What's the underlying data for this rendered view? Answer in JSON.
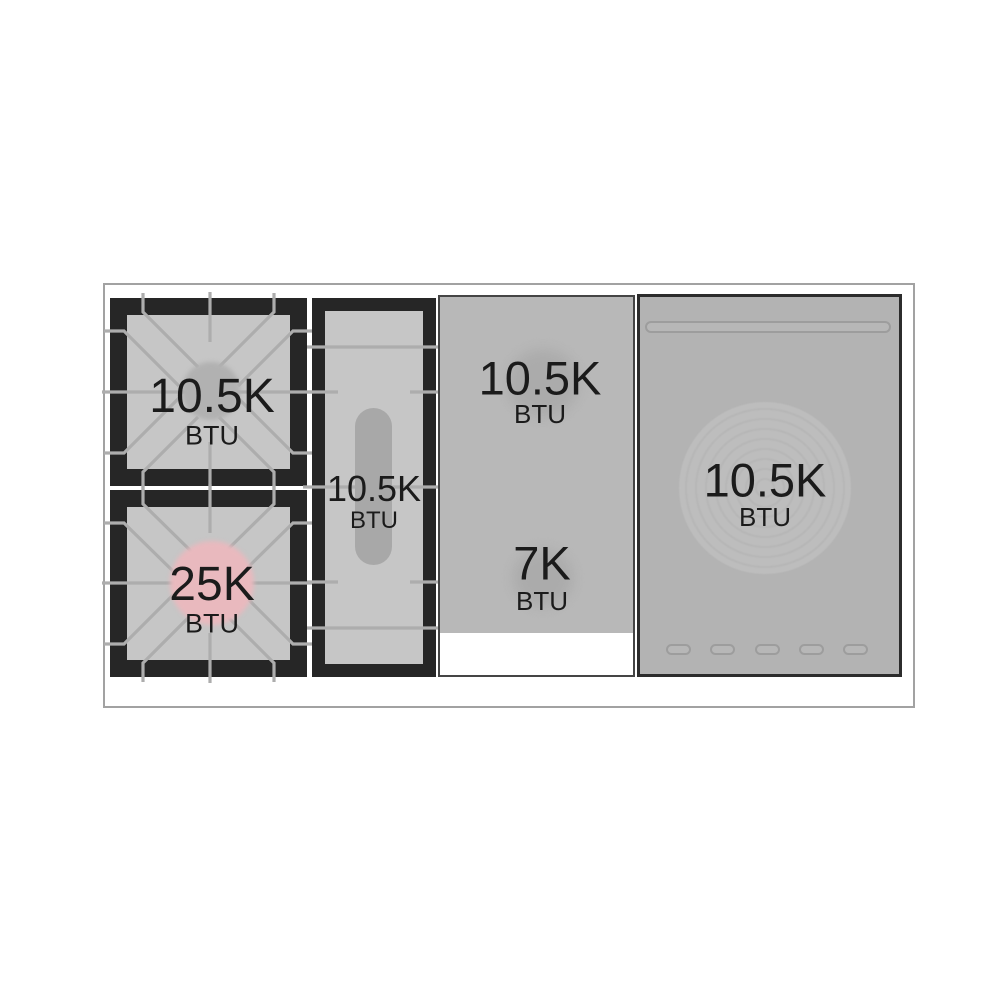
{
  "diagram": {
    "type": "range-cooktop-spec",
    "zones": {
      "left_rear": {
        "power": "10.5K",
        "unit": "BTU"
      },
      "left_front": {
        "power": "25K",
        "unit": "BTU"
      },
      "griddle": {
        "power": "10.5K",
        "unit": "BTU"
      },
      "center_upper": {
        "power": "10.5K",
        "unit": "BTU"
      },
      "center_lower": {
        "power": "7K",
        "unit": "BTU"
      },
      "right": {
        "power": "10.5K",
        "unit": "BTU"
      }
    },
    "colors": {
      "burner_highlight_pink": "#e9b9be",
      "grate_black": "#262626",
      "grate_surface_gray": "#c6c6c6",
      "panel_gray": "#b5b5b5",
      "frame_gray": "#a2a2a2"
    }
  }
}
